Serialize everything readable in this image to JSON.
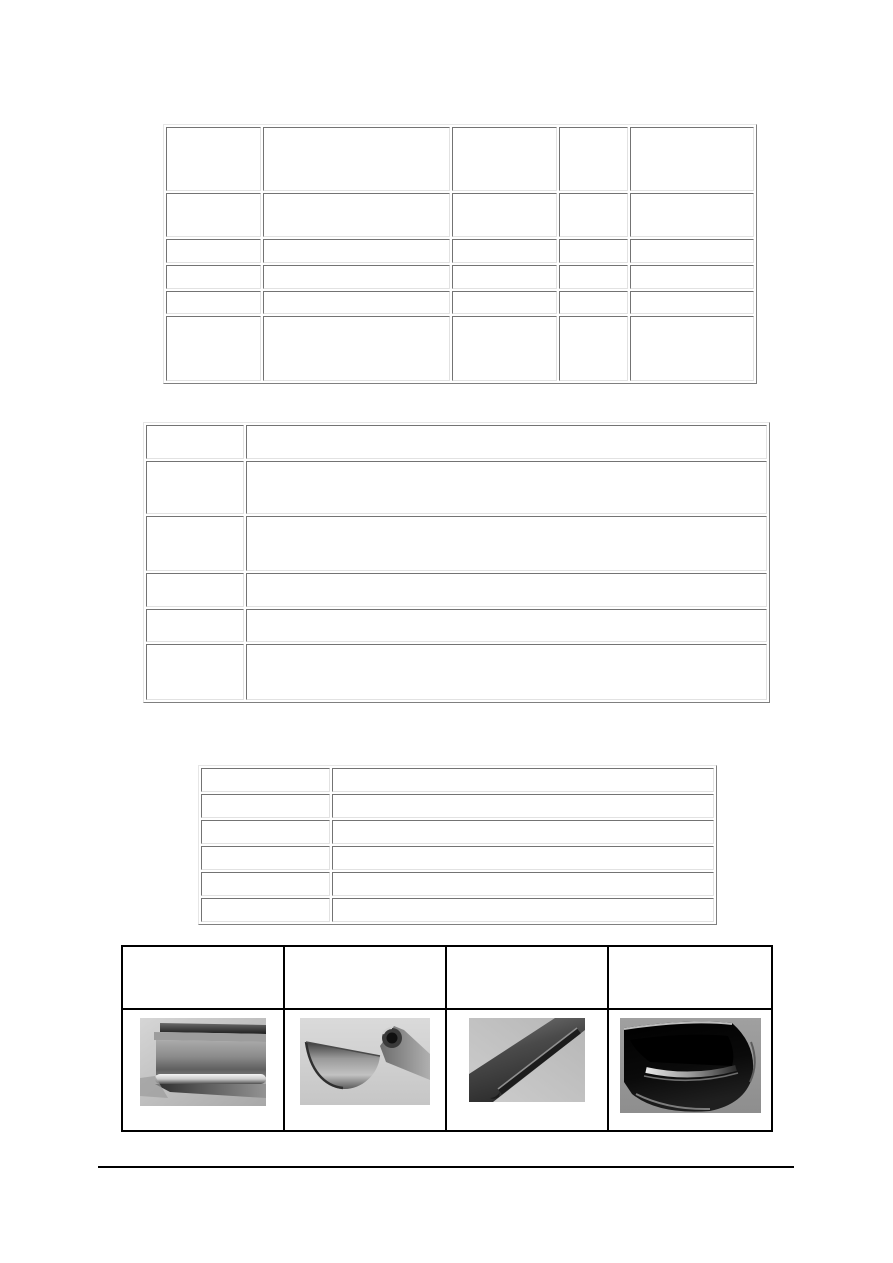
{
  "page": {
    "width": 893,
    "height": 1263,
    "background": "#ffffff"
  },
  "colors": {
    "classic_border_outset_light": "#e6e6e6",
    "classic_border_outset_dark": "#7f7f7f",
    "classic_cell_border_dark": "#737373",
    "classic_cell_border_light": "#e2e2e2",
    "photo_table_border": "#000000",
    "footer_rule": "#000000"
  },
  "table1": {
    "name": "top-specs-table",
    "columns": 5,
    "rows": [
      [
        "",
        "",
        "",
        "",
        ""
      ],
      [
        "",
        "",
        "",
        "",
        ""
      ],
      [
        "",
        "",
        "",
        "",
        ""
      ],
      [
        "",
        "",
        "",
        "",
        ""
      ],
      [
        "",
        "",
        "",
        "",
        ""
      ],
      [
        "",
        "",
        "",
        "",
        ""
      ]
    ]
  },
  "table2": {
    "name": "middle-description-table",
    "columns": 2,
    "rows": [
      [
        "",
        ""
      ],
      [
        "",
        ""
      ],
      [
        "",
        ""
      ],
      [
        "",
        ""
      ],
      [
        "",
        ""
      ],
      [
        "",
        ""
      ]
    ]
  },
  "table3": {
    "name": "lower-list-table",
    "columns": 2,
    "rows": [
      [
        "",
        ""
      ],
      [
        "",
        ""
      ],
      [
        "",
        ""
      ],
      [
        "",
        ""
      ],
      [
        "",
        ""
      ],
      [
        "",
        ""
      ]
    ]
  },
  "table4": {
    "name": "gutter-photos-table",
    "columns": 4,
    "header_cells": [
      "",
      "",
      "",
      ""
    ],
    "photos": [
      {
        "name": "box-profile-gutter-photo",
        "kind": "grayscale photo: rectangular box gutter profile, end view"
      },
      {
        "name": "half-round-gutter-curl-photo",
        "kind": "grayscale photo: half-round steel gutter with curled bead"
      },
      {
        "name": "dark-angled-gutter-photo",
        "kind": "grayscale photo: dark gutter profile running diagonally"
      },
      {
        "name": "black-half-round-gutter-photo",
        "kind": "grayscale photo: black glossy half-round gutter, end view"
      }
    ]
  }
}
